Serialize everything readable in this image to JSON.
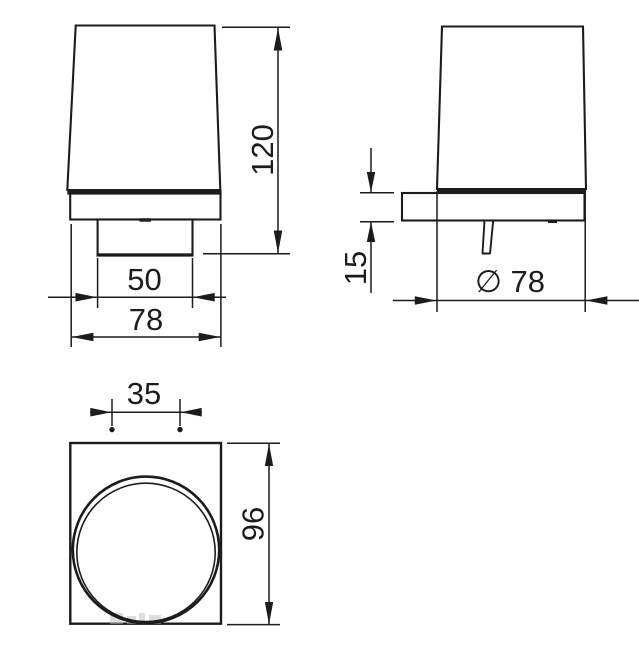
{
  "drawing": {
    "kind": "technical-orthographic-drawing",
    "subject": "wall-mounted tumbler holder",
    "colors": {
      "line": "#1c1c1c",
      "background": "#ffffff",
      "watermark": "#bdbdbd"
    },
    "views": {
      "front": {
        "dims": {
          "height": "120",
          "bracket_width": "50",
          "overall_width": "78"
        }
      },
      "side": {
        "dims": {
          "plate_thickness": "15",
          "diameter": "∅ 78"
        }
      },
      "top": {
        "dims": {
          "hole_spacing": "35",
          "depth": "96"
        }
      }
    }
  }
}
